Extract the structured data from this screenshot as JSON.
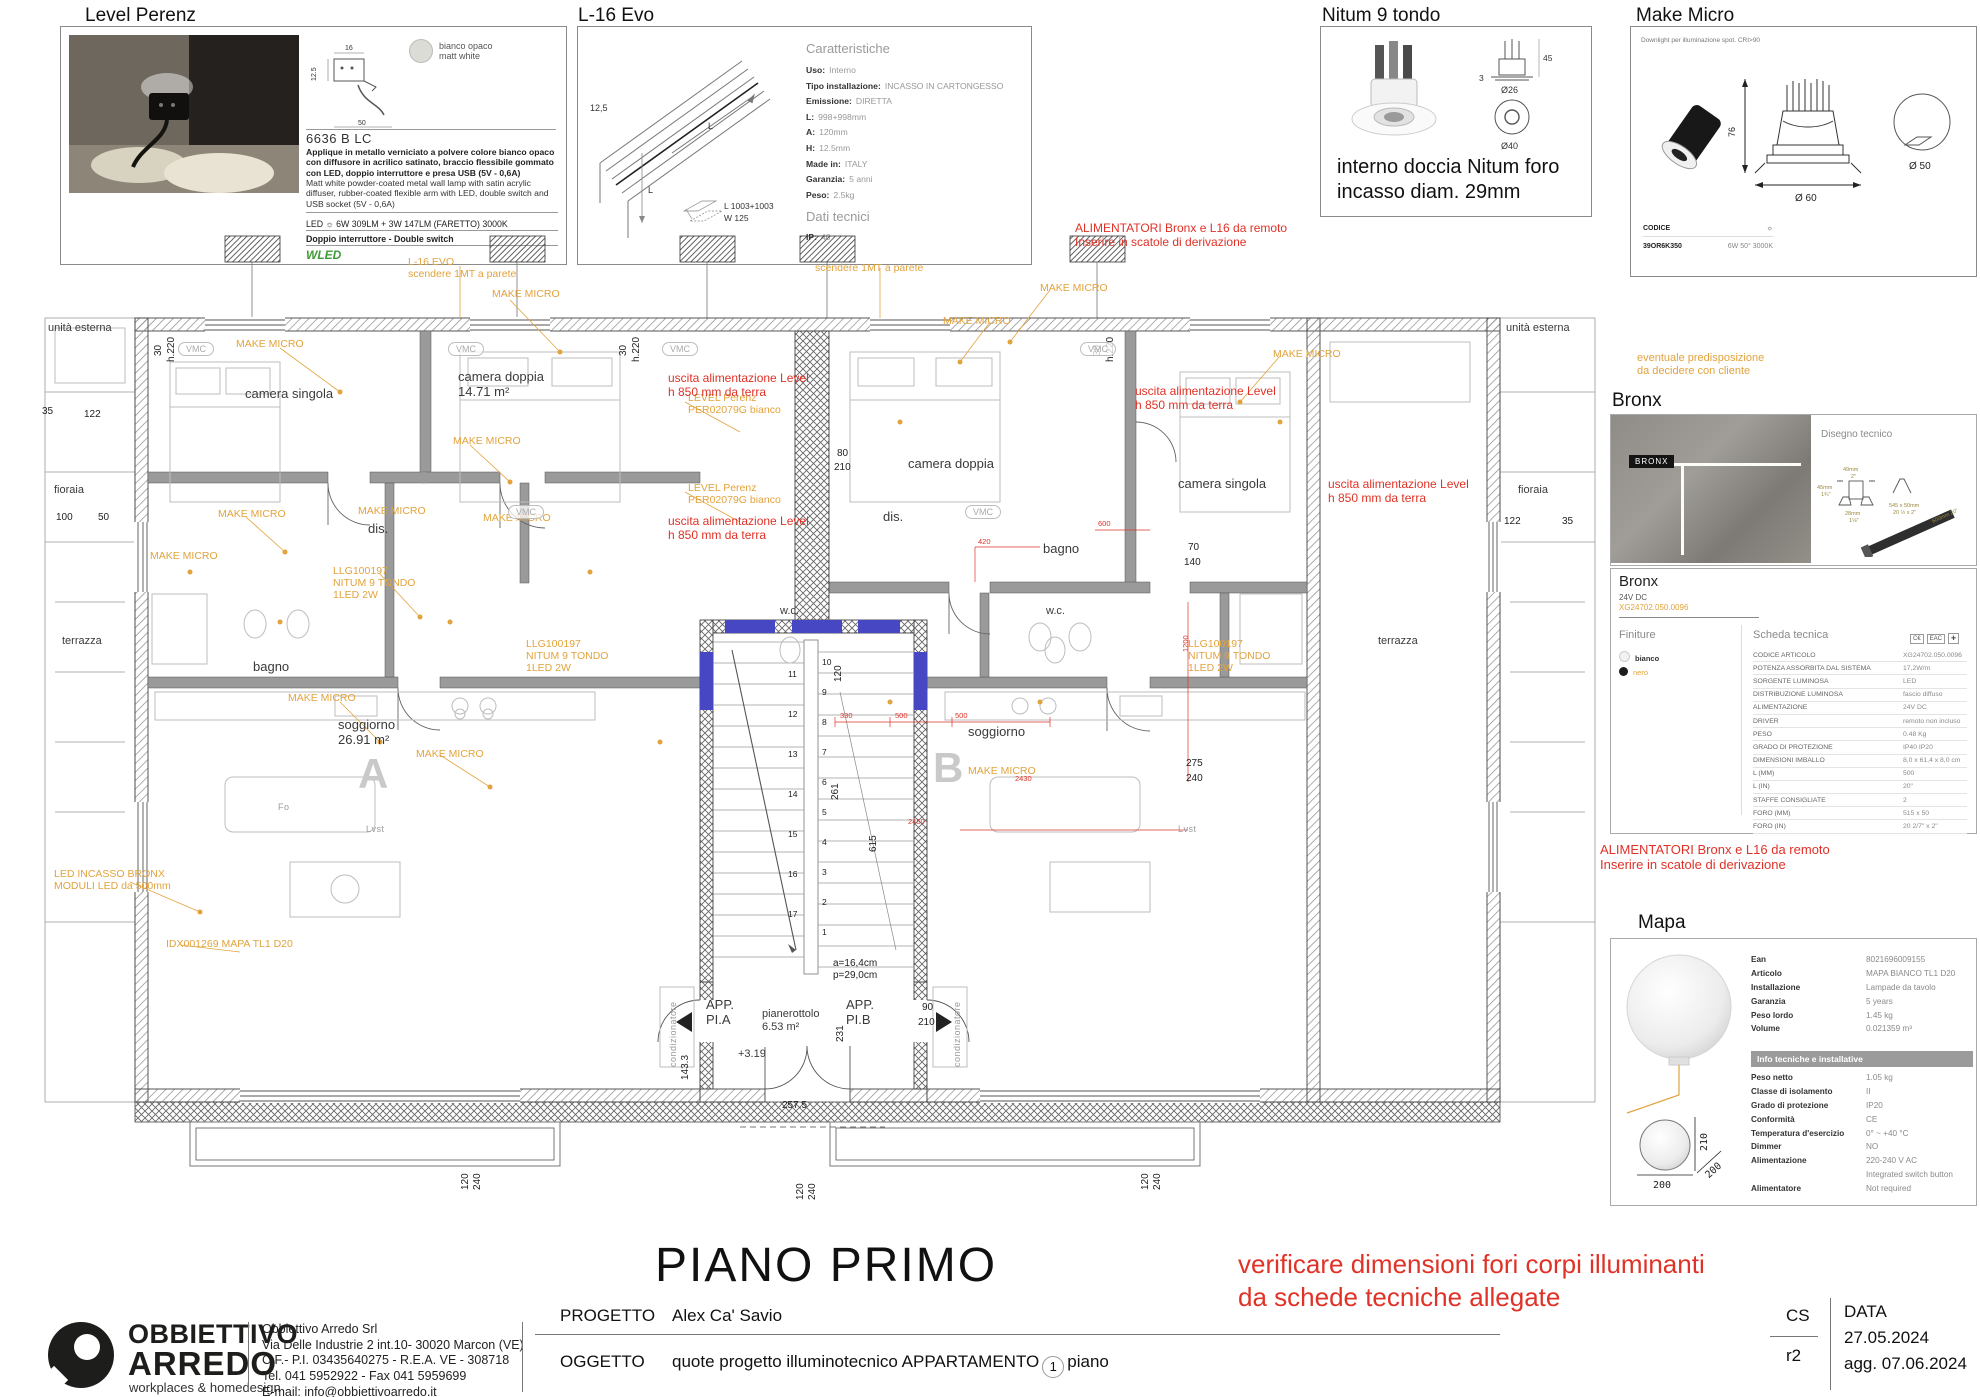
{
  "panels": {
    "level_perenz": {
      "title": "Level Perenz",
      "finish_chip": "bianco opaco\nmatt white",
      "diagram_dims": {
        "w": "16",
        "h": "12.5",
        "d": "50"
      },
      "code": "6636 B LC",
      "desc_it": "Applique in metallo verniciato a polvere colore bianco opaco con diffusore in acrilico satinato, braccio flessibile gommato con LED, doppio interruttore e presa USB (5V - 0,6A)",
      "desc_en": "Matt white powder-coated metal wall lamp with satin acrylic diffuser, rubber-coated flexible arm with LED, double switch and USB socket (5V - 0,6A)",
      "led_line": "LED ☼ 6W 309LM + 3W 147LM (FARETTO) 3000K",
      "switch_line": "Doppio interruttore - Double switch",
      "brand": "WLED"
    },
    "l16_evo": {
      "title": "L-16 Evo",
      "drawing": {
        "thickness": "12,5",
        "len1": "L",
        "len2": "L",
        "module_l": "L  1003+1003",
        "module_w": "W  125"
      },
      "caratteristiche_title": "Caratteristiche",
      "specs": [
        {
          "l": "Uso:",
          "v": "Interno"
        },
        {
          "l": "Tipo installazione:",
          "v": "INCASSO IN CARTONGESSO"
        },
        {
          "l": "Emissione:",
          "v": "DIRETTA"
        },
        {
          "l": "L:",
          "v": "998+998mm"
        },
        {
          "l": "A:",
          "v": "120mm"
        },
        {
          "l": "H:",
          "v": "12.5mm"
        },
        {
          "l": "Made in:",
          "v": "ITALY"
        },
        {
          "l": "Garanzia:",
          "v": "5 anni"
        },
        {
          "l": "Peso:",
          "v": "2.5kg"
        }
      ],
      "dati_title": "Dati tecnici",
      "ip_label": "IP:",
      "ip_value": "40"
    },
    "nitum": {
      "title": "Nitum 9 tondo",
      "dims": {
        "h": "45",
        "t": "3",
        "d1": "Ø26",
        "d2": "Ø40"
      },
      "note": "interno doccia Nitum foro\nincasso diam. 29mm"
    },
    "make_micro": {
      "title": "Make Micro",
      "subtitle": "Downlight per illuminazione spot. CRI>90",
      "dims": {
        "h": "76",
        "d": "Ø 60",
        "cut": "Ø 50"
      },
      "codice_label": "CODICE",
      "lamp_icon": "☼",
      "code": "39OR6K350",
      "spec": "6W 50° 3000K"
    },
    "orange_note": "eventuale predisposizione\nda decidere con cliente",
    "bronx_photo": {
      "title": "Bronx",
      "tag": "BRONX",
      "disegno": "Disegno tecnico",
      "d1": "49mm",
      "d1b": "2\"",
      "d2": "45mm",
      "d2b": "1¾\"",
      "d3": "28mm",
      "d3b": "1⅛\"",
      "d4": "545 x 50mm\n20 ½ x 2\"",
      "d5": "600mm",
      "d5b": "20\""
    },
    "bronx_sheet": {
      "title": "Bronx",
      "subtitle": "24V DC",
      "code_orange": "XG24702.050.0096",
      "finiture_title": "Finiture",
      "finitura1": "bianco",
      "finitura2": "nero",
      "scheda_title": "Scheda tecnica",
      "marks": [
        "C€",
        "EAC",
        "✚"
      ],
      "rows": [
        {
          "l": "CODICE ARTICOLO",
          "v": "XG24702.050.0096"
        },
        {
          "l": "POTENZA ASSORBITA DAL SISTEMA",
          "v": "17,2W/m"
        },
        {
          "l": "SORGENTE LUMINOSA",
          "v": "LED"
        },
        {
          "l": "DISTRIBUZIONE LUMINOSA",
          "v": "fascio diffuso"
        },
        {
          "l": "ALIMENTAZIONE",
          "v": "24V DC"
        },
        {
          "l": "DRIVER",
          "v": "remoto non incluso"
        },
        {
          "l": "PESO",
          "v": "0.48 Kg"
        },
        {
          "l": "GRADO DI PROTEZIONE",
          "v": "IP40 IP20"
        },
        {
          "l": "DIMENSIONI IMBALLO",
          "v": "8,0 x 61,4 x 8,0 cm"
        },
        {
          "l": "L (MM)",
          "v": "500"
        },
        {
          "l": "L (IN)",
          "v": "20\""
        },
        {
          "l": "STAFFE CONSIGLIATE",
          "v": "2"
        },
        {
          "l": "FORO (MM)",
          "v": "515 x 50"
        },
        {
          "l": "FORO (IN)",
          "v": "20 2/7\" x 2\""
        }
      ]
    },
    "alimentatori_note": "ALIMENTATORI Bronx e L16 da remoto\nInserire in scatole di derivazione",
    "alimentatori_note_top": "ALIMENTATORI Bronx e L16 da remoto\nInserire in scatole di derivazione",
    "mapa": {
      "title": "Mapa",
      "dims": {
        "w": "200",
        "h": "210",
        "d": "200"
      },
      "rows1": [
        {
          "l": "Ean",
          "v": "8021696009155"
        },
        {
          "l": "Articolo",
          "v": "MAPA BIANCO TL1 D20"
        },
        {
          "l": "Installazione",
          "v": "Lampade da tavolo"
        },
        {
          "l": "Garanzia",
          "v": "5 years"
        },
        {
          "l": "Peso lordo",
          "v": "1.45 kg"
        },
        {
          "l": "Volume",
          "v": "0.021359 m³"
        }
      ],
      "info_header": "Info tecniche e installative",
      "rows2": [
        {
          "l": "Peso netto",
          "v": "1.05 kg"
        },
        {
          "l": "Classe di isolamento",
          "v": "II"
        },
        {
          "l": "Grado di protezione",
          "v": "IP20"
        },
        {
          "l": "Conformità",
          "v": "CE"
        },
        {
          "l": "Temperatura d'esercizio",
          "v": "0° ~ +40 °C"
        },
        {
          "l": "Dimmer",
          "v": "NO"
        },
        {
          "l": "Alimentazione",
          "v": "220-240 V AC"
        },
        {
          "l": "",
          "v": "Integrated switch button"
        },
        {
          "l": "Alimentatore",
          "v": "Not required"
        }
      ]
    }
  },
  "plan": {
    "title": "PIANO PRIMO",
    "vmc_label": "VMC",
    "vmc": [
      {
        "x": 138,
        "y": 120
      },
      {
        "x": 408,
        "y": 120
      },
      {
        "x": 622,
        "y": 120
      },
      {
        "x": 1040,
        "y": 120
      },
      {
        "x": 468,
        "y": 283
      },
      {
        "x": 925,
        "y": 283
      }
    ],
    "stair_left": [
      "11",
      "12",
      "13",
      "14",
      "15",
      "16",
      "17"
    ],
    "stair_right": [
      "10",
      "9",
      "8",
      "7",
      "6",
      "5",
      "4",
      "3",
      "2",
      "1"
    ],
    "labels": [
      {
        "c": "r",
        "x": 205,
        "y": 165,
        "t": "camera singola"
      },
      {
        "c": "r",
        "x": 418,
        "y": 148,
        "t": "camera doppia\n14.71 m²"
      },
      {
        "c": "r",
        "x": 868,
        "y": 235,
        "t": "camera doppia"
      },
      {
        "c": "r",
        "x": 1138,
        "y": 255,
        "t": "camera singola"
      },
      {
        "c": "r",
        "x": 328,
        "y": 300,
        "t": "dis."
      },
      {
        "c": "r",
        "x": 213,
        "y": 438,
        "t": "bagno"
      },
      {
        "c": "r",
        "x": 843,
        "y": 288,
        "t": "dis."
      },
      {
        "c": "r",
        "x": 1003,
        "y": 320,
        "t": "bagno"
      },
      {
        "c": "rs",
        "x": 740,
        "y": 383,
        "t": "w.c."
      },
      {
        "c": "rs",
        "x": 1006,
        "y": 383,
        "t": "w.c."
      },
      {
        "c": "r",
        "x": 298,
        "y": 496,
        "t": "soggiorno\n26.91 m²"
      },
      {
        "c": "big",
        "x": 318,
        "y": 528,
        "t": "A"
      },
      {
        "c": "r",
        "x": 928,
        "y": 503,
        "t": "soggiorno"
      },
      {
        "c": "big",
        "x": 893,
        "y": 522,
        "t": "B"
      },
      {
        "c": "r",
        "x": 666,
        "y": 776,
        "t": "APP.\nPI.A"
      },
      {
        "c": "r",
        "x": 806,
        "y": 776,
        "t": "APP.\nPI.B"
      },
      {
        "c": "rs",
        "x": 722,
        "y": 786,
        "t": "pianerottolo\n6.53 m²"
      },
      {
        "c": "rs",
        "x": 698,
        "y": 826,
        "t": "+3.19"
      },
      {
        "c": "rs",
        "x": 8,
        "y": 100,
        "t": "unità esterna"
      },
      {
        "c": "rs",
        "x": 14,
        "y": 262,
        "t": "fioraia"
      },
      {
        "c": "rs",
        "x": 22,
        "y": 413,
        "t": "terrazza"
      },
      {
        "c": "rs",
        "x": 1466,
        "y": 100,
        "t": "unità esterna"
      },
      {
        "c": "rs",
        "x": 1478,
        "y": 262,
        "t": "fioraia"
      },
      {
        "c": "rs",
        "x": 1338,
        "y": 413,
        "t": "terrazza"
      },
      {
        "c": "g",
        "x": 238,
        "y": 580,
        "t": "Fo"
      },
      {
        "c": "g",
        "x": 326,
        "y": 602,
        "t": "Lvst"
      },
      {
        "c": "g",
        "x": 1138,
        "y": 602,
        "t": "Lvst"
      },
      {
        "c": "g",
        "x": 628,
        "y": 845,
        "t": "condizionatore",
        "rot": 1
      },
      {
        "c": "g",
        "x": 912,
        "y": 845,
        "t": "condizionatore",
        "rot": 1
      },
      {
        "c": "g",
        "x": 378,
        "y": 262,
        "t": "condizionatore",
        "rot": 1
      },
      {
        "c": "d",
        "x": 2,
        "y": 184,
        "t": "35"
      },
      {
        "c": "d",
        "x": 44,
        "y": 187,
        "t": "122"
      },
      {
        "c": "d",
        "x": 16,
        "y": 290,
        "t": "100"
      },
      {
        "c": "d",
        "x": 58,
        "y": 290,
        "t": "50"
      },
      {
        "c": "d",
        "x": 1464,
        "y": 294,
        "t": "122"
      },
      {
        "c": "d",
        "x": 1522,
        "y": 294,
        "t": "35"
      },
      {
        "c": "d",
        "x": 1148,
        "y": 320,
        "t": "70"
      },
      {
        "c": "d",
        "x": 1144,
        "y": 335,
        "t": "140"
      },
      {
        "c": "d",
        "x": 1146,
        "y": 536,
        "t": "275"
      },
      {
        "c": "d",
        "x": 1146,
        "y": 551,
        "t": "240"
      },
      {
        "c": "d",
        "x": 882,
        "y": 780,
        "t": "90"
      },
      {
        "c": "d",
        "x": 878,
        "y": 795,
        "t": "210"
      },
      {
        "c": "d",
        "x": 640,
        "y": 858,
        "t": "143.3",
        "rot": 1
      },
      {
        "c": "d",
        "x": 795,
        "y": 820,
        "t": "231",
        "rot": 1
      },
      {
        "c": "d",
        "x": 742,
        "y": 878,
        "t": "257.5"
      },
      {
        "c": "d",
        "x": 793,
        "y": 460,
        "t": "120",
        "rot": 1
      },
      {
        "c": "d",
        "x": 790,
        "y": 578,
        "t": "261",
        "rot": 1
      },
      {
        "c": "d",
        "x": 828,
        "y": 630,
        "t": "615",
        "rot": 1
      },
      {
        "c": "d",
        "x": 793,
        "y": 736,
        "t": "a=16,4cm"
      },
      {
        "c": "d",
        "x": 793,
        "y": 748,
        "t": "p=29,0cm"
      },
      {
        "c": "d",
        "x": 420,
        "y": 968,
        "t": "120",
        "rot": 1
      },
      {
        "c": "d",
        "x": 432,
        "y": 968,
        "t": "240",
        "rot": 1
      },
      {
        "c": "d",
        "x": 755,
        "y": 978,
        "t": "120",
        "rot": 1
      },
      {
        "c": "d",
        "x": 767,
        "y": 978,
        "t": "240",
        "rot": 1
      },
      {
        "c": "d",
        "x": 1100,
        "y": 968,
        "t": "120",
        "rot": 1
      },
      {
        "c": "d",
        "x": 1112,
        "y": 968,
        "t": "240",
        "rot": 1
      },
      {
        "c": "d",
        "x": 113,
        "y": 134,
        "t": "30",
        "rot": 1
      },
      {
        "c": "d",
        "x": 126,
        "y": 140,
        "t": "h.220",
        "rot": 1
      },
      {
        "c": "d",
        "x": 578,
        "y": 134,
        "t": "30",
        "rot": 1
      },
      {
        "c": "d",
        "x": 591,
        "y": 140,
        "t": "h.220",
        "rot": 1
      },
      {
        "c": "d",
        "x": 1052,
        "y": 134,
        "t": "30",
        "rot": 1
      },
      {
        "c": "d",
        "x": 1065,
        "y": 140,
        "t": "h.220",
        "rot": 1
      },
      {
        "c": "d",
        "x": 797,
        "y": 226,
        "t": "80"
      },
      {
        "c": "d",
        "x": 794,
        "y": 240,
        "t": "210"
      },
      {
        "c": "o",
        "x": 196,
        "y": 116,
        "t": "MAKE MICRO"
      },
      {
        "c": "o",
        "x": 452,
        "y": 66,
        "t": "MAKE MICRO"
      },
      {
        "c": "o",
        "x": 368,
        "y": 34,
        "t": "L-16  EVO\nscendere 1MT a parete"
      },
      {
        "c": "o",
        "x": 775,
        "y": 40,
        "t": "scendere 1MT a parete"
      },
      {
        "c": "o",
        "x": 1000,
        "y": 60,
        "t": "MAKE MICRO"
      },
      {
        "c": "o",
        "x": 648,
        "y": 170,
        "t": "LEVEL Perenz\nPER02079G bianco"
      },
      {
        "c": "o",
        "x": 648,
        "y": 260,
        "t": "LEVEL Perenz\nPER02079G bianco"
      },
      {
        "c": "o",
        "x": 413,
        "y": 213,
        "t": "MAKE MICRO"
      },
      {
        "c": "o",
        "x": 178,
        "y": 286,
        "t": "MAKE MICRO"
      },
      {
        "c": "o",
        "x": 318,
        "y": 283,
        "t": "MAKE MICRO"
      },
      {
        "c": "o",
        "x": 110,
        "y": 328,
        "t": "MAKE MICRO"
      },
      {
        "c": "o",
        "x": 443,
        "y": 290,
        "t": "MAKE MICRO"
      },
      {
        "c": "o",
        "x": 293,
        "y": 343,
        "t": "LLG100197\nNITUM 9 TONDO\n1LED 2W"
      },
      {
        "c": "o",
        "x": 486,
        "y": 416,
        "t": "LLG100197\nNITUM 9 TONDO\n1LED 2W"
      },
      {
        "c": "o",
        "x": 1148,
        "y": 416,
        "t": "LLG100197\nNITUM 9 TONDO\n1LED 2W"
      },
      {
        "c": "o",
        "x": 248,
        "y": 470,
        "t": "MAKE MICRO"
      },
      {
        "c": "o",
        "x": 376,
        "y": 526,
        "t": "MAKE MICRO"
      },
      {
        "c": "o",
        "x": 903,
        "y": 93,
        "t": "MAKE MICRO"
      },
      {
        "c": "o",
        "x": 1233,
        "y": 126,
        "t": "MAKE MICRO"
      },
      {
        "c": "o",
        "x": 928,
        "y": 543,
        "t": "MAKE MICRO"
      },
      {
        "c": "o",
        "x": 14,
        "y": 646,
        "t": "LED INCASSO BRONX\nMODULI LED da 500mm"
      },
      {
        "c": "o",
        "x": 126,
        "y": 716,
        "t": "IDX001269  MAPA TL1 D20"
      },
      {
        "c": "rd",
        "x": 1035,
        "y": 0,
        "t": "ALIMENTATORI Bronx e L16 da remoto\nInserire in scatole di derivazione"
      },
      {
        "c": "rd",
        "x": 628,
        "y": 150,
        "t": "uscita alimentazione Level\nh 850 mm da terra"
      },
      {
        "c": "rd",
        "x": 628,
        "y": 293,
        "t": "uscita alimentazione Level\nh 850 mm da terra"
      },
      {
        "c": "rd",
        "x": 1095,
        "y": 163,
        "t": "uscita alimentazione Level\nh 850 mm da terra"
      },
      {
        "c": "rd",
        "x": 1288,
        "y": 256,
        "t": "uscita alimentazione Level\nh 850 mm da terra"
      },
      {
        "c": "rdim",
        "x": 800,
        "y": 490,
        "t": "330"
      },
      {
        "c": "rdim",
        "x": 855,
        "y": 490,
        "t": "500"
      },
      {
        "c": "rdim",
        "x": 915,
        "y": 490,
        "t": "500"
      },
      {
        "c": "rdim",
        "x": 975,
        "y": 553,
        "t": "2430"
      },
      {
        "c": "rdim",
        "x": 868,
        "y": 596,
        "t": "2450"
      },
      {
        "c": "rdim",
        "x": 1142,
        "y": 430,
        "t": "1200",
        "rot": 1
      },
      {
        "c": "rdim",
        "x": 938,
        "y": 316,
        "t": "420"
      },
      {
        "c": "rdim",
        "x": 1058,
        "y": 298,
        "t": "600"
      }
    ]
  },
  "warning_note": "verificare dimensioni fori corpi illuminanti\nda schede tecniche allegate",
  "titleblock": {
    "company1": "OBBIETTIVO",
    "company2": "ARREDO",
    "tagline": "workplaces & homedesign",
    "addr1": "Obbiettivo Arredo Srl",
    "addr2": "Via Delle Industrie 2 int.10- 30020 Marcon (VE)",
    "addr3": "C.F.- P.I. 03435640275  - R.E.A. VE - 308718",
    "addr4": "Tel. 041 5952922 - Fax 041 5959699",
    "addr5": "E-mail: info@obbiettivoarredo.it",
    "progetto_label": "PROGETTO",
    "progetto": "Alex Ca' Savio",
    "oggetto_label": "OGGETTO",
    "oggetto_pre": "quote progetto illuminotecnico APPARTAMENTO",
    "oggetto_badge": "1",
    "oggetto_post": "piano",
    "rev_top": "CS",
    "rev_bottom": "r2",
    "data_label": "DATA",
    "data1": "27.05.2024",
    "data2": "agg. 07.06.2024"
  }
}
